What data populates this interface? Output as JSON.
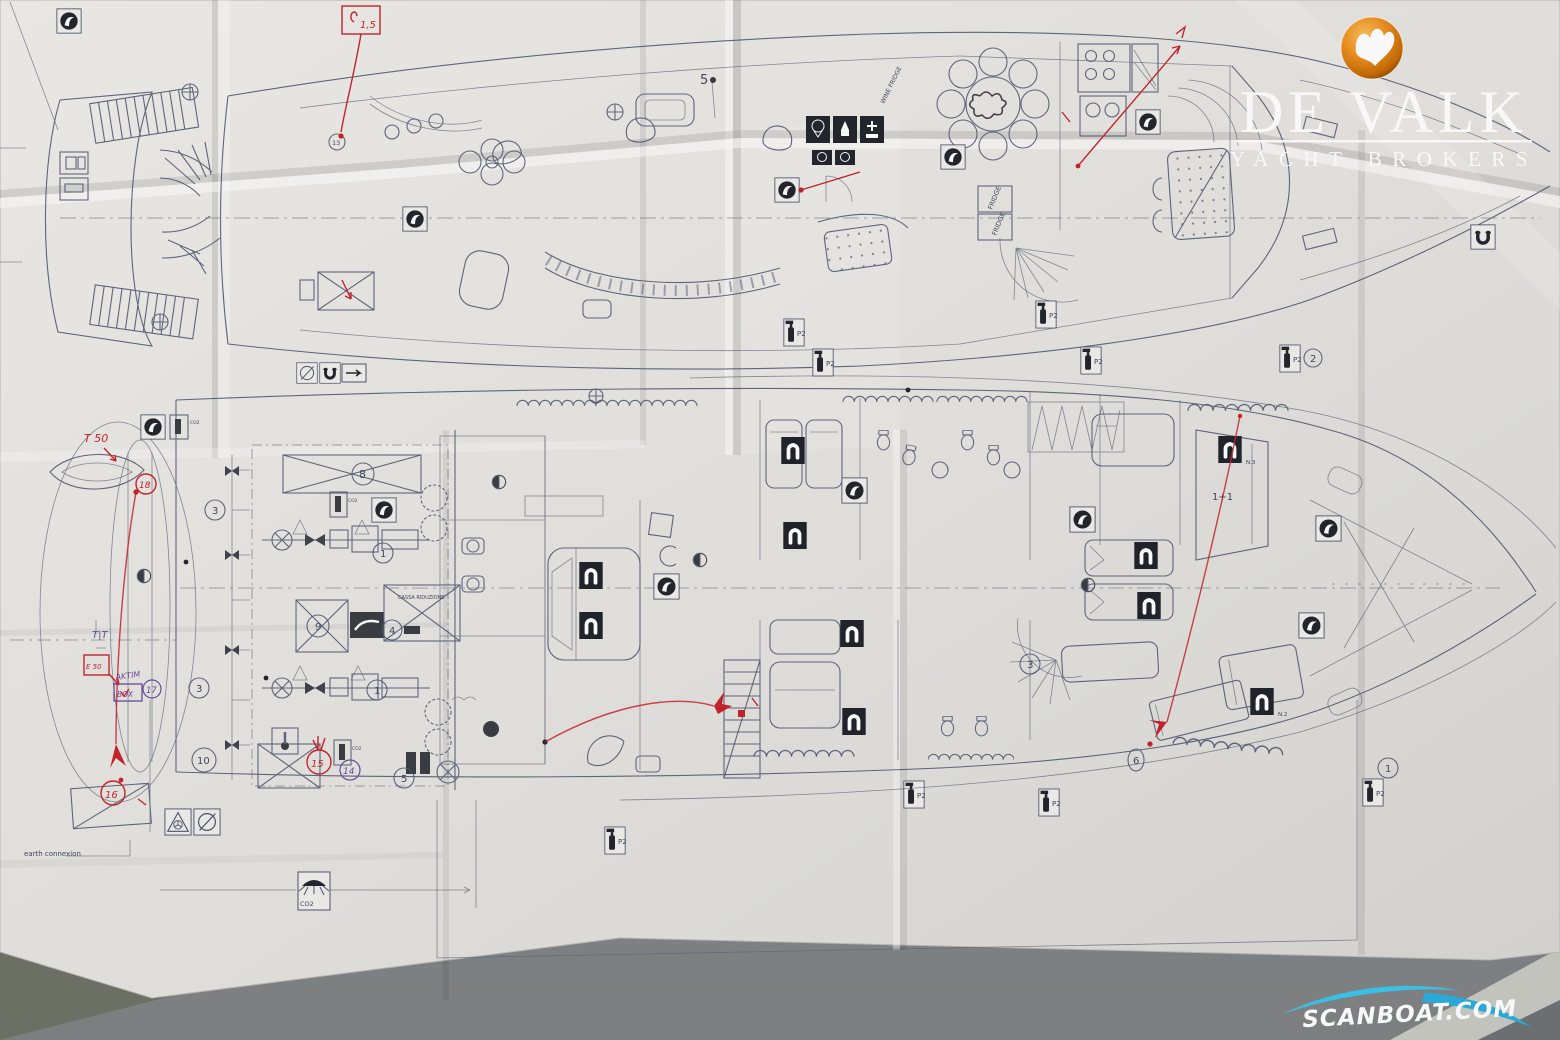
{
  "scene": {
    "brand": "DE VALK",
    "brand_sub": "YACHT BROKERS",
    "watermark": "SCANBOAT.COM"
  },
  "colors": {
    "logo_orange": "#e8820c",
    "swoosh_cyan": "#2fb9e4",
    "annotation_red": "#c8242b",
    "annotation_purple": "#6a4e9e",
    "drawing_ink": "#4d5670",
    "paper": "#eceae6",
    "table": "#8f9192"
  },
  "upper_deck": {
    "frame_number": "5",
    "fridge_a": "FRIDGE",
    "fridge_b": "FRIDGE",
    "wine_fridge": "WINE FRIDGE"
  },
  "lower_deck": {
    "cassa_box": "CASSA RIDUZIONE",
    "earth": "earth connexion",
    "co2": "CO2",
    "berth": "1+1",
    "cabin_n2": "N.2",
    "cabin_n3": "N.3",
    "fire_ext": "P2"
  },
  "circles": {
    "c8": "8",
    "c1a": "1",
    "c1b": "1",
    "c1c": "1",
    "c2": "2",
    "c3a": "3",
    "c3b": "3",
    "c3c": "3",
    "c4": "4",
    "c5": "5",
    "c6": "6",
    "c9": "9",
    "c10": "10",
    "c13": "13",
    "c14": "14"
  },
  "red_notes": {
    "rate": "1,5",
    "t50": "T 50",
    "e50": "E 50",
    "tt": "T|T",
    "aktim": "AKTIM",
    "box": "BOX",
    "r15": "15",
    "r16": "16",
    "r17": "17",
    "r18": "18"
  }
}
